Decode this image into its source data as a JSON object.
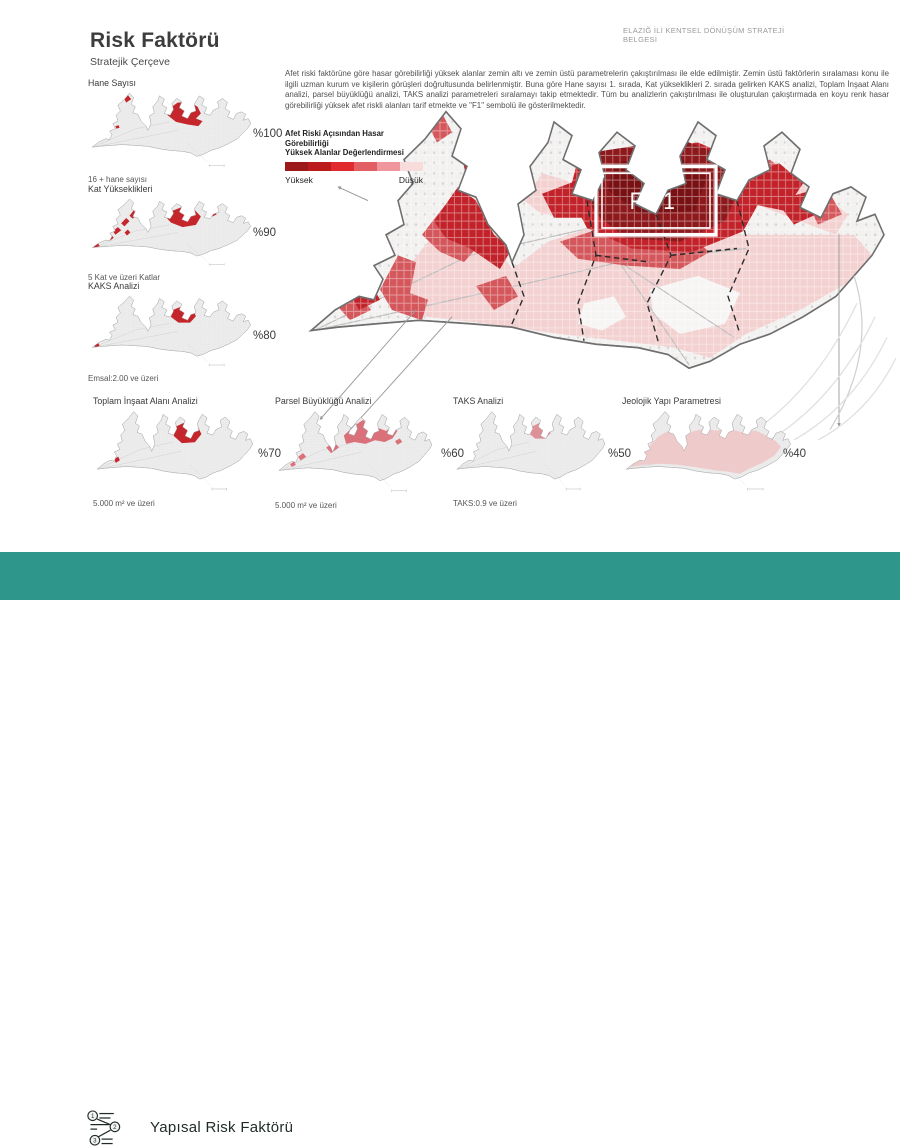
{
  "header": {
    "title": "Risk Faktörü",
    "subtitle": "Stratejik Çerçeve",
    "doc_label": "ELAZIĞ İLİ KENTSEL DÖNÜŞÜM STRATEJİ BELGESİ"
  },
  "intro_text": "Afet riski faktörüne göre hasar görebilirliği yüksek alanlar zemin altı ve zemin üstü parametrelerin çakıştırılması ile elde edilmiştir. Zemin üstü faktörlerin sıralaması konu ile ilgili uzman kurum ve kişilerin görüşleri doğrultusunda belirlenmiştir. Buna göre Hane sayısı 1. sırada, Kat yükseklikleri 2. sırada gelirken KAKS analizi, Toplam İnşaat Alanı analizi, parsel büyüklüğü analizi, TAKS analizi parametreleri sıralamayı takip etmektedir. Tüm bu analizlerin çakıştırılması ile oluşturulan çakıştırmada en koyu renk hasar görebilirliği yüksek afet riskli alanları tarif etmekte ve \"F1\" sembolü ile gösterilmektedir.",
  "legend": {
    "title_line1": "Afet Riski Açısından Hasar Görebilirliği",
    "title_line2": "Yüksek Alanlar Değerlendirmesi",
    "label_high": "Yüksek",
    "label_low": "Düşük",
    "colors": [
      "#9D1A1A",
      "#BB1B1D",
      "#E12A2D",
      "#E25F64",
      "#F0979D",
      "#F8DBDB"
    ]
  },
  "main_map": {
    "zone_label": "F 1"
  },
  "mini_maps": [
    {
      "id": "hane",
      "title": "Hane Sayısı",
      "weight": "%100",
      "caption": "16 + hane sayısı"
    },
    {
      "id": "kat",
      "title": "Kat Yükseklikleri",
      "weight": "%90",
      "caption": "5 Kat ve üzeri Katlar"
    },
    {
      "id": "kaks",
      "title": "KAKS Analizi",
      "weight": "%80",
      "caption": "Emsal:2.00 ve üzeri"
    },
    {
      "id": "toplam",
      "title": "Toplam İnşaat Alanı Analizi",
      "weight": "%70",
      "caption": "5.000 m² ve üzeri"
    },
    {
      "id": "parsel",
      "title": "Parsel Büyüklüğü Analizi",
      "weight": "%60",
      "caption": "5.000 m² ve üzeri"
    },
    {
      "id": "taks",
      "title": "TAKS Analizi",
      "weight": "%50",
      "caption": "TAKS:0.9 ve üzeri"
    },
    {
      "id": "jeolojik",
      "title": "Jeolojik Yapı Parametresi",
      "weight": "%40",
      "caption": ""
    }
  ],
  "footer": {
    "title": "Yapısal Risk Faktörü",
    "logo_text": "keym",
    "logo_sub": [
      "kentsel",
      "yenileme",
      "merkezi"
    ],
    "icon_steps": [
      "1",
      "2",
      "3"
    ]
  },
  "colors": {
    "accent_teal": "#2F968C",
    "risk_red_strong": "#C4262B",
    "risk_red_mid": "#D4575C",
    "risk_red_light": "#D9707A",
    "risk_red_lighter": "#DE9198",
    "risk_wash": "#EECACA",
    "risk_dark_core": "#8E191D"
  }
}
